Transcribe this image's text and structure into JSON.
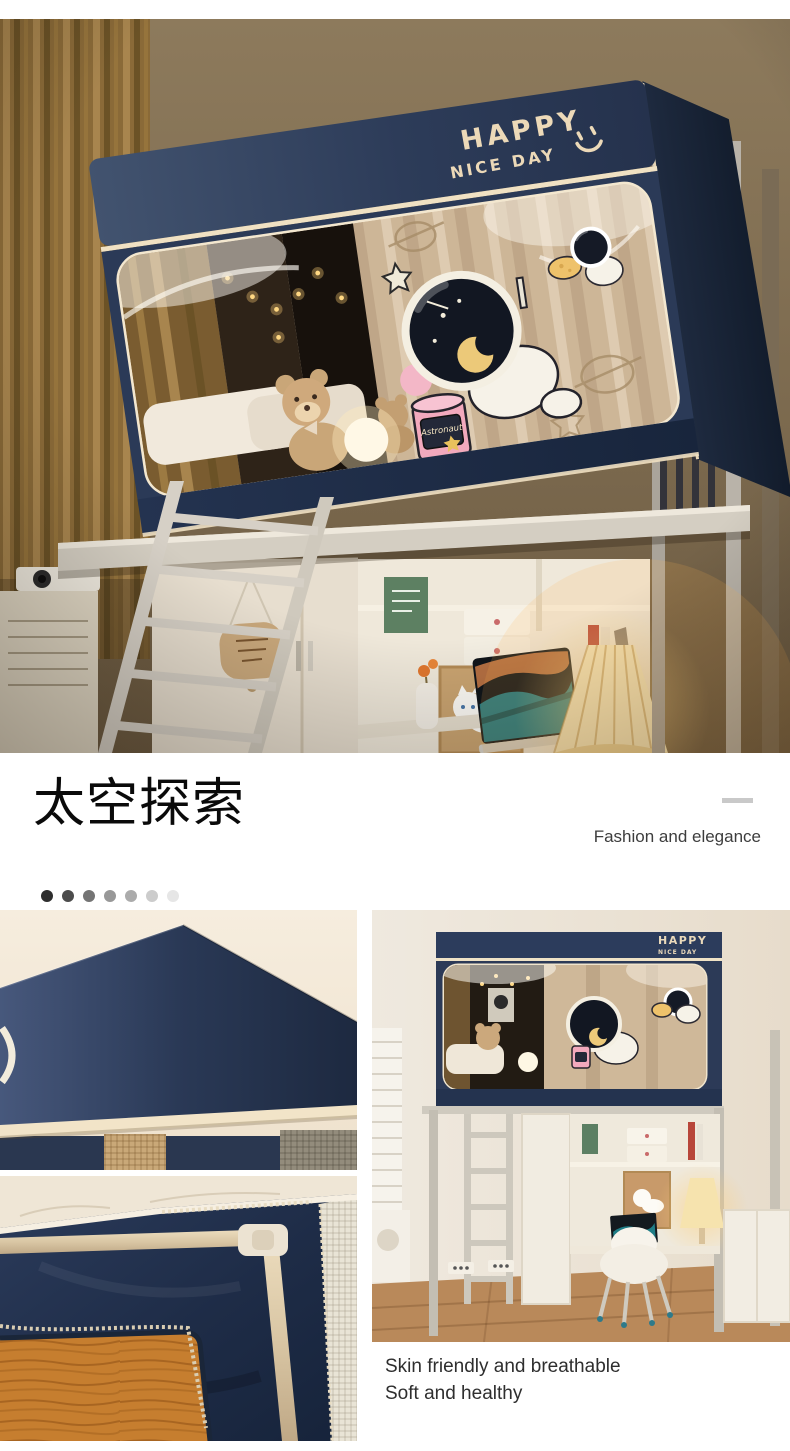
{
  "hero": {
    "brand_line1": "HAPPY",
    "brand_line2": "NICE DAY",
    "jar_label": "Astronaut"
  },
  "headline": {
    "title": "太空探索",
    "tagline": "Fashion and elegance"
  },
  "pagination_dots": {
    "colors": [
      "#2e2e2e",
      "#4c4c4c",
      "#747474",
      "#989898",
      "#ababab",
      "#cccccc",
      "#e6e6e6"
    ]
  },
  "gallery": {
    "images": [
      "canopy-corner-closeup",
      "frame-pole-zipper-closeup",
      "dorm-room-full-view"
    ],
    "caption_line1": "Skin friendly and breathable",
    "caption_line2": "Soft and healthy"
  },
  "colors": {
    "canopy_navy": "#2b3a57",
    "canopy_navy_dark": "#16233a",
    "piping_cream": "#f0e1c3",
    "interior_beige": "#cdb697",
    "wall_brown": "#7e6b50",
    "wall_light": "#ece5da",
    "curtain_gold": "#8a6a38",
    "wood_board": "#c07a2e",
    "dash_gray": "#c9c9c9"
  }
}
